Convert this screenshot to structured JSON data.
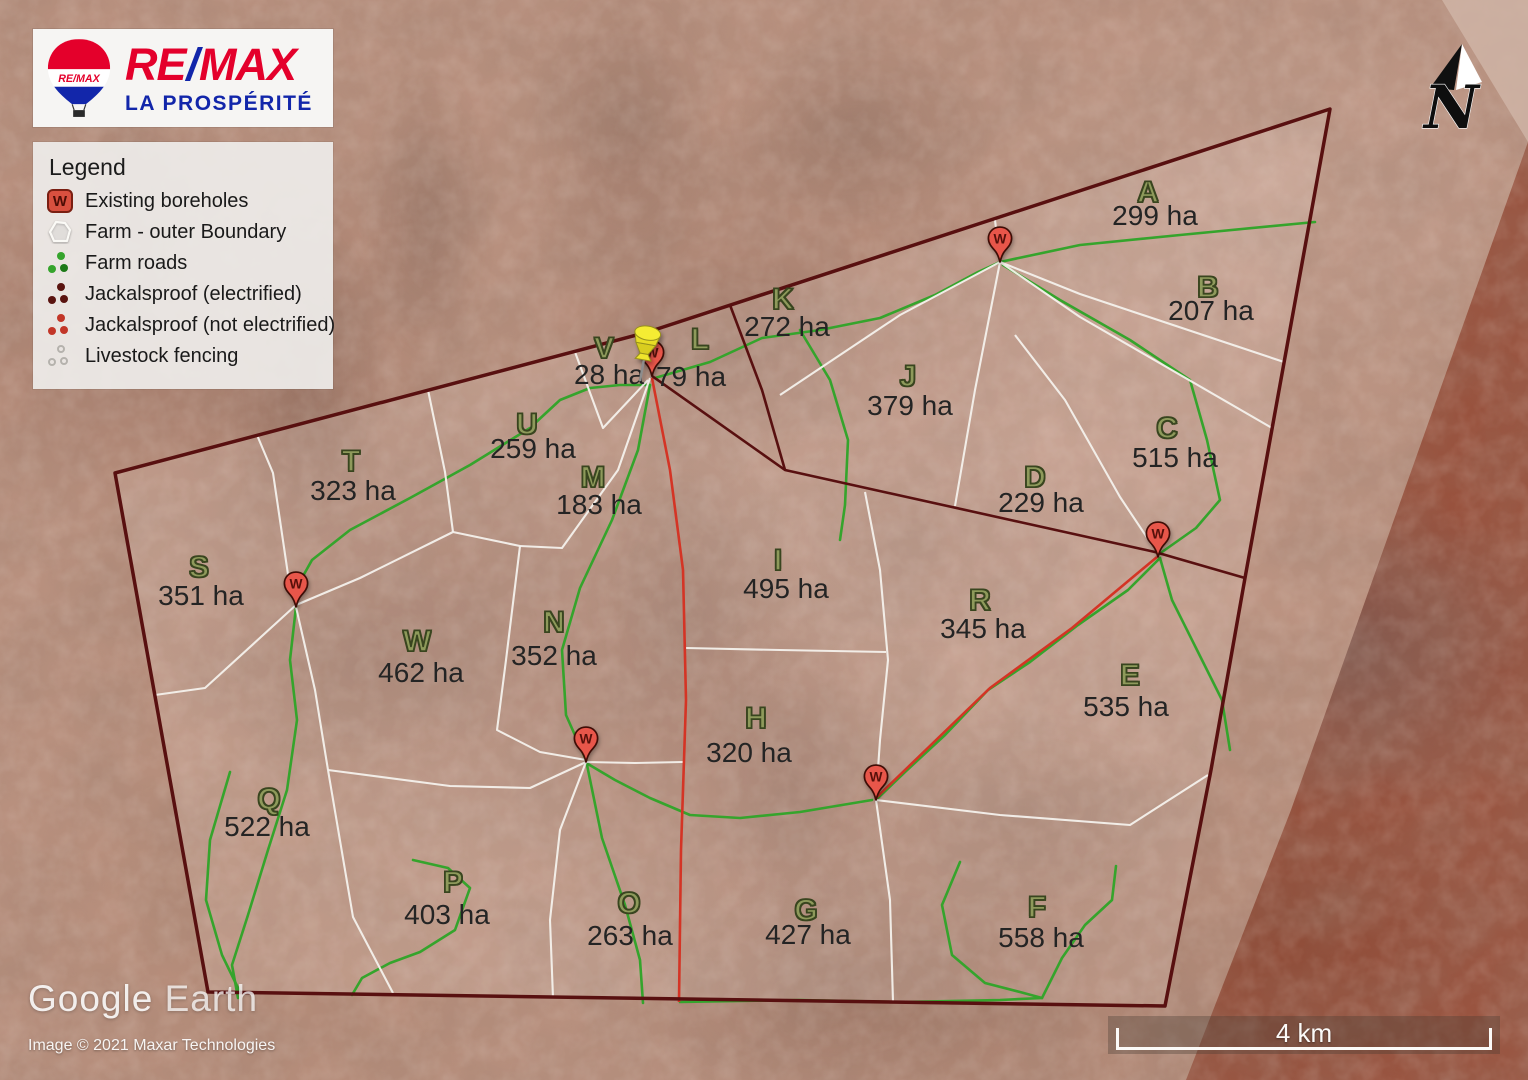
{
  "branding": {
    "re": "RE",
    "slash": "/",
    "max": "MAX",
    "office": "LA PROSPÉRITÉ",
    "balloon_text": "RE/MAX"
  },
  "legend": {
    "title": "Legend",
    "items": [
      {
        "label": "Existing boreholes",
        "icon": "borehole-icon"
      },
      {
        "label": "Farm - outer Boundary",
        "icon": "boundary-icon"
      },
      {
        "label": "Farm roads",
        "icon": "farm-roads-icon"
      },
      {
        "label": "Jackalsproof (electrified)",
        "icon": "jackalsproof-electrified-icon"
      },
      {
        "label": "Jackalsproof (not electrified)",
        "icon": "jackalsproof-icon"
      },
      {
        "label": "Livestock fencing",
        "icon": "livestock-fencing-icon"
      }
    ]
  },
  "north_arrow": {
    "label": "N"
  },
  "scale_bar": {
    "label": "4 km"
  },
  "watermark": {
    "title_google": "Google",
    "title_earth": "Earth",
    "credit": "Image © 2021 Maxar Technologies"
  },
  "map": {
    "borehole_label": "W",
    "boreholes": [
      {
        "x": 652,
        "y": 376
      },
      {
        "x": 1000,
        "y": 262
      },
      {
        "x": 1158,
        "y": 557
      },
      {
        "x": 296,
        "y": 607
      },
      {
        "x": 586,
        "y": 762
      },
      {
        "x": 876,
        "y": 800
      }
    ],
    "pushpin": {
      "x": 640,
      "y": 381
    },
    "parcels": [
      {
        "id": "A",
        "area": "299 ha",
        "x": 1148,
        "y": 193,
        "ax": 1155,
        "ay": 216
      },
      {
        "id": "B",
        "area": "207 ha",
        "x": 1208,
        "y": 288,
        "ax": 1211,
        "ay": 311
      },
      {
        "id": "C",
        "area": "515 ha",
        "x": 1167,
        "y": 429,
        "ax": 1175,
        "ay": 458
      },
      {
        "id": "D",
        "area": "229 ha",
        "x": 1035,
        "y": 478,
        "ax": 1041,
        "ay": 503
      },
      {
        "id": "E",
        "area": "535 ha",
        "x": 1130,
        "y": 676,
        "ax": 1126,
        "ay": 707
      },
      {
        "id": "F",
        "area": "558 ha",
        "x": 1037,
        "y": 908,
        "ax": 1041,
        "ay": 938
      },
      {
        "id": "G",
        "area": "427 ha",
        "x": 806,
        "y": 911,
        "ax": 808,
        "ay": 935
      },
      {
        "id": "H",
        "area": "320 ha",
        "x": 756,
        "y": 719,
        "ax": 749,
        "ay": 753
      },
      {
        "id": "I",
        "area": "495 ha",
        "x": 778,
        "y": 561,
        "ax": 786,
        "ay": 589
      },
      {
        "id": "J",
        "area": "379 ha",
        "x": 908,
        "y": 377,
        "ax": 910,
        "ay": 406
      },
      {
        "id": "K",
        "area": "272 ha",
        "x": 783,
        "y": 300,
        "ax": 787,
        "ay": 327
      },
      {
        "id": "L",
        "area": "79 ha",
        "x": 700,
        "y": 340,
        "ax": 691,
        "ay": 377
      },
      {
        "id": "M",
        "area": "183 ha",
        "x": 593,
        "y": 478,
        "ax": 599,
        "ay": 505
      },
      {
        "id": "N",
        "area": "352 ha",
        "x": 554,
        "y": 623,
        "ax": 554,
        "ay": 656
      },
      {
        "id": "O",
        "area": "263 ha",
        "x": 629,
        "y": 904,
        "ax": 630,
        "ay": 936
      },
      {
        "id": "P",
        "area": "403 ha",
        "x": 453,
        "y": 883,
        "ax": 447,
        "ay": 915
      },
      {
        "id": "Q",
        "area": "522 ha",
        "x": 269,
        "y": 800,
        "ax": 267,
        "ay": 827
      },
      {
        "id": "R",
        "area": "345 ha",
        "x": 980,
        "y": 601,
        "ax": 983,
        "ay": 629
      },
      {
        "id": "S",
        "area": "351 ha",
        "x": 199,
        "y": 568,
        "ax": 201,
        "ay": 596
      },
      {
        "id": "T",
        "area": "323 ha",
        "x": 351,
        "y": 462,
        "ax": 353,
        "ay": 491
      },
      {
        "id": "U",
        "area": "259 ha",
        "x": 527,
        "y": 425,
        "ax": 533,
        "ay": 449
      },
      {
        "id": "V",
        "area": "28 ha",
        "x": 604,
        "y": 349,
        "ax": 609,
        "ay": 375
      },
      {
        "id": "W",
        "area": "462 ha",
        "x": 417,
        "y": 642,
        "ax": 421,
        "ay": 673
      }
    ]
  },
  "colors": {
    "boundary_maroon": "#581010",
    "road_green": "#35a42c",
    "fence_white": "#f4f1ec",
    "jackal_red": "#d43425",
    "brand_red": "#e4002b",
    "brand_blue": "#1226aa",
    "letter_olive": "#8e9a5b"
  }
}
